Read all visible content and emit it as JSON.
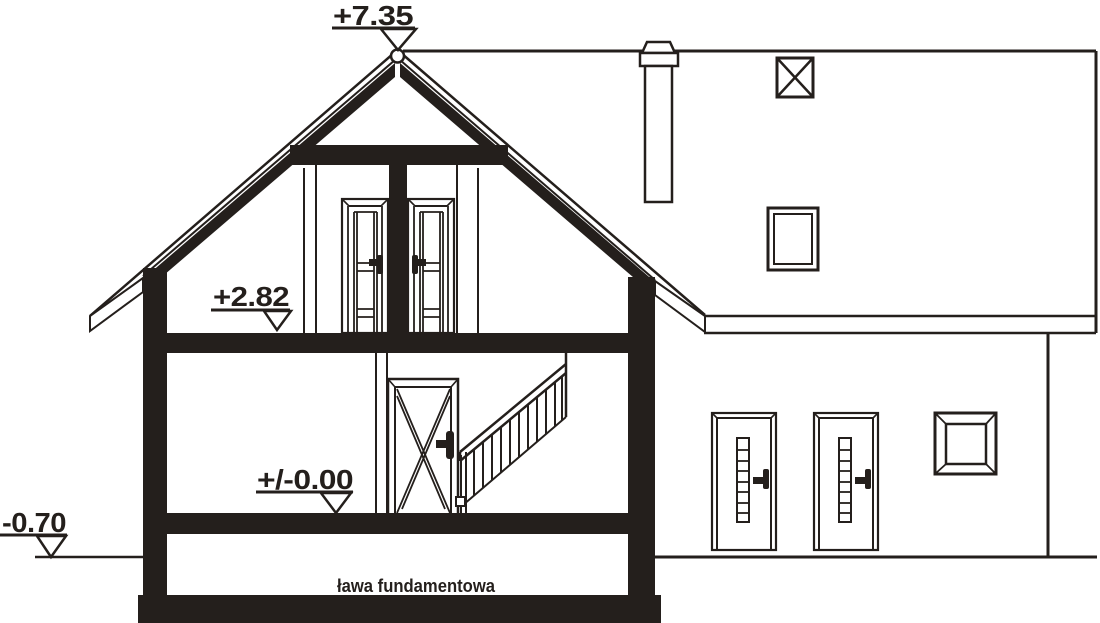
{
  "colors": {
    "ink": "#241f1c",
    "paper": "#ffffff"
  },
  "elevation_markers": [
    {
      "id": "roof-ridge",
      "label": "+7.35"
    },
    {
      "id": "attic-floor",
      "label": "+2.82"
    },
    {
      "id": "ground-floor",
      "label": "+/-0.00"
    },
    {
      "id": "ground-level",
      "label": "-0.70"
    }
  ],
  "labels": {
    "foundation": "ława fundamentowa"
  }
}
